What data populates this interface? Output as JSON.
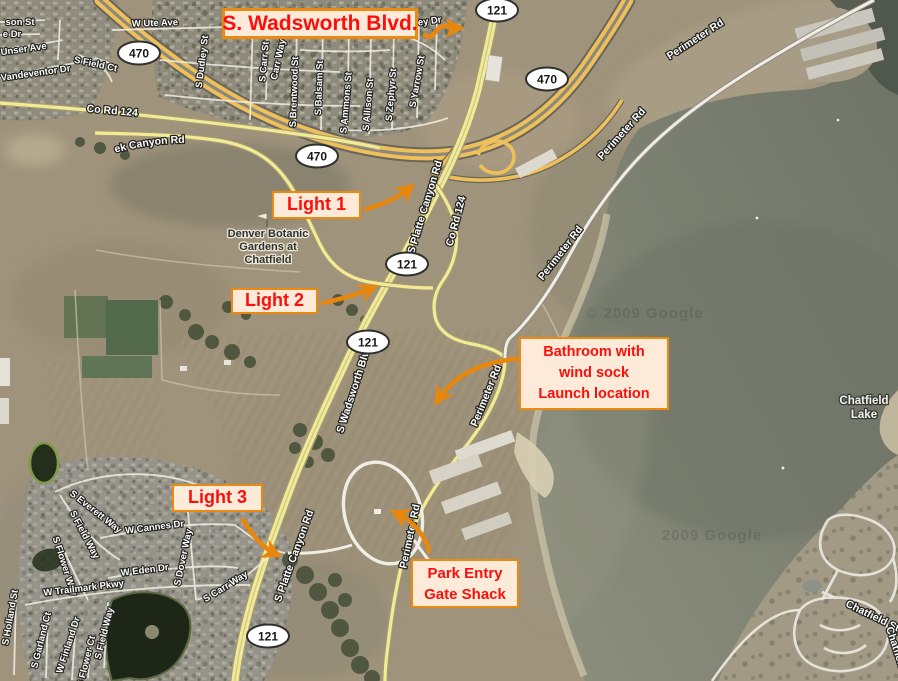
{
  "map_type": "satellite",
  "callouts": {
    "wadsworth": {
      "text": "S. Wadsworth Blvd."
    },
    "light1": {
      "text": "Light 1"
    },
    "light2": {
      "text": "Light 2"
    },
    "light3": {
      "text": "Light 3"
    },
    "bathroom": {
      "line1": "Bathroom with",
      "line2": "wind sock",
      "line3": "Launch location"
    },
    "gate": {
      "line1": "Park Entry",
      "line2": "Gate Shack"
    }
  },
  "shields": {
    "hwy470": "470",
    "hwy121": "121"
  },
  "roads": {
    "w_ute_ave": "W Ute Ave",
    "ey_dr": "ey Dr",
    "s_dudley_st": "S Dudley St",
    "s_carr_st": "S Carr St",
    "carr_way": "Carr Way",
    "s_brentwood_st": "S Brentwood St",
    "s_balsam_st": "S Balsam St",
    "s_ammons_st": "S Ammons St",
    "s_allison_st": "S Allison St",
    "s_zephyr_st": "S Zephyr St",
    "s_yarrow_st": "S Yarrow St",
    "son_st": "son St",
    "e_dr": "e Dr",
    "unser_ave": "Unser Ave",
    "vandeventor_dr": "Vandeventor Dr",
    "s_field_ct": "S Field Ct",
    "co_rd_124": "Co Rd 124",
    "w_deer_creek": "W Deer Creek Canyon Rd",
    "s_platte_canyon_rd": "S Platte Canyon Rd",
    "s_wadsworth_blvd": "S Wadsworth Blvd",
    "perimeter_rd": "Perimeter Rd",
    "s_everett_way": "S Everett Way",
    "s_field_way": "S Field Way",
    "s_flower_way": "S Flower Way",
    "w_cannes_dr": "W Cannes Dr",
    "w_eden_dr": "W Eden Dr",
    "s_dover_way": "S Dover Way",
    "w_trailmark_pkwy": "W Trailmark Pkwy",
    "s_carr_way": "S Carr Way",
    "s_holland_st": "S Holland St",
    "s_garland_ct": "S Garland Ct",
    "w_finland_dr": "W Finland Dr",
    "s_flower_ct": "S Flower Ct"
  },
  "places": {
    "botanic1": "Denver Botanic",
    "botanic2": "Gardens at",
    "botanic3": "Chatfield",
    "lake1": "Chatfield",
    "lake2": "Lake",
    "state_park": "Chatfield State Park",
    "state_park_corner": "Chatfield Sta"
  },
  "watermark": {
    "text": "© 2009 Google",
    "text2": "2009 Google"
  }
}
